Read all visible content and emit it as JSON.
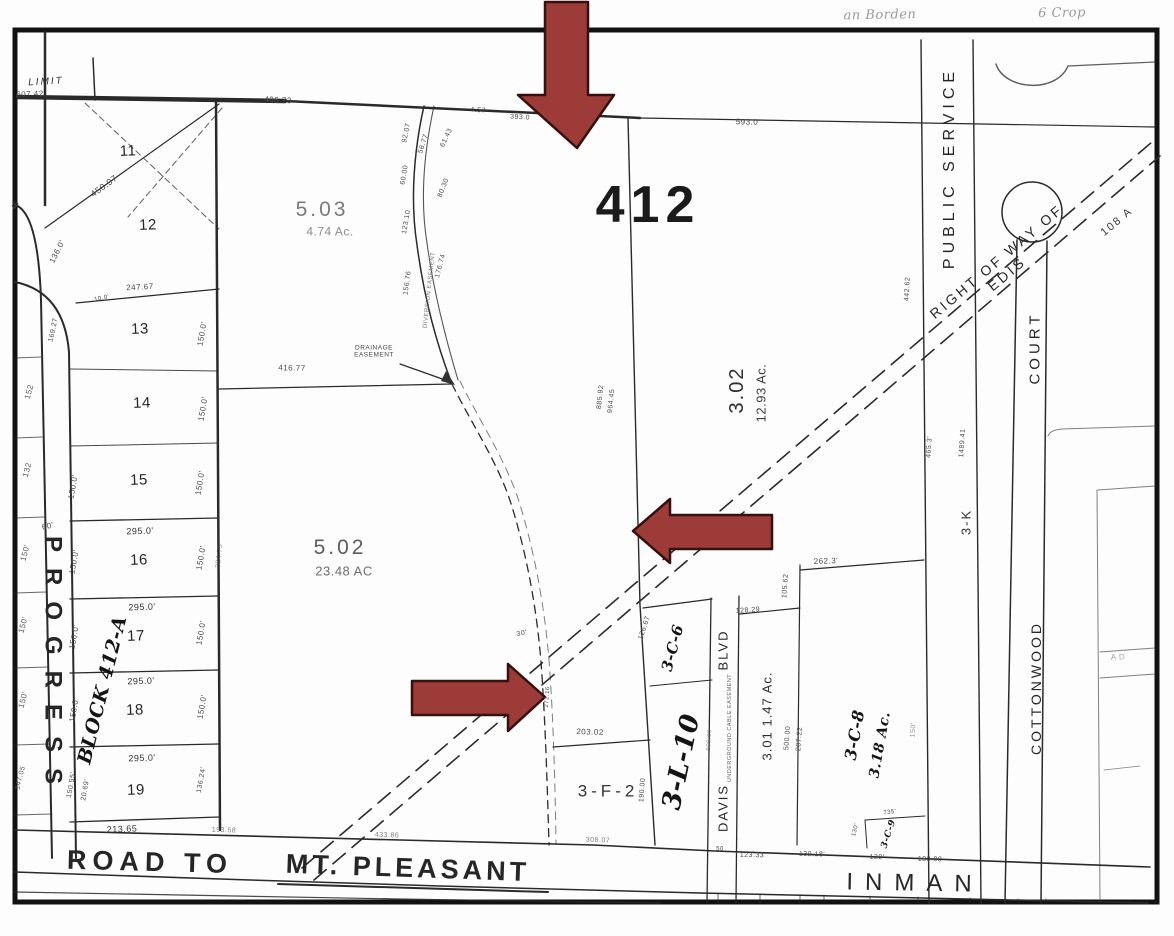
{
  "notes": {
    "top_left": "an Borden",
    "top_right": "6  Crop"
  },
  "streets": {
    "progress": "PROGRESS",
    "road_to": "ROAD  TO",
    "mt_pleasant": "MT. PLEASANT",
    "inman": "INMAN",
    "davis": "DAVIS",
    "blvd": "BLVD",
    "underground": "UNDERGROUND CABLE EASEMENT",
    "cottonwood": "COTTONWOOD",
    "court": "COURT",
    "public_service": "PUBLIC  SERVICE",
    "right_of_way": "RIGHT  OF  WAY  OF  EDIS",
    "row_108": "108 A"
  },
  "parcels": {
    "p412": "412",
    "p503": "5.03",
    "p503_ac": "4.74 Ac.",
    "p502": "5.02",
    "p502_ac": "23.48 AC",
    "p302": "3.02",
    "p302_ac": "12.93 Ac.",
    "p3f2": "3-F-2",
    "p3l10": "3-L-10",
    "p3c6": "3-C-6",
    "p301": "3.01  1.47 Ac.",
    "p3c8": "3-C-8",
    "p3c8_ac": "3.18 Ac.",
    "p3c9": "3-C-9",
    "p3k": "3-K",
    "block": "BLOCK 412-A",
    "limit": "LIMIT"
  },
  "easements": {
    "drainage": "DRAINAGE\nEASEMENT",
    "diversion": "DIVERSION EASEMENT"
  },
  "lots": [
    "11",
    "12",
    "13",
    "14",
    "15",
    "16",
    "17",
    "18",
    "19"
  ],
  "left_col": [
    "152",
    "132",
    "150'",
    "150'",
    "150'",
    "147.05"
  ],
  "measurements": [
    "607.42",
    "406.73",
    "4.57",
    "393.0",
    "593.0'",
    "450.97",
    "45",
    "136.0'",
    "247.67",
    "169.27",
    "10.0'",
    "416.77",
    "92.07",
    "56.77",
    "61.43",
    "60.00",
    "80.30",
    "123.10",
    "156.76",
    "176.74",
    "885.92",
    "964.45",
    "442.62",
    "465.3'",
    "1489.41",
    "295.0'",
    "295.0'",
    "295.0'",
    "295.0'",
    "213.65",
    "150.0'",
    "150.0'",
    "150.0'",
    "150.0'",
    "150.0'",
    "150.0'",
    "150.0'",
    "150.0'",
    "150.55'",
    "20.69'",
    "136.24'",
    "60'",
    "324.75",
    "193.58",
    "433.86",
    "308.07",
    "203.02",
    "272.16",
    "30'",
    "190.00",
    "126.67",
    "128.29",
    "105.62",
    "500.00",
    "207.22",
    "600.00",
    "262.3'",
    "150'",
    "735'",
    "130'",
    "50",
    "123.33",
    "139.18'",
    "120'",
    "180.00",
    "150.0'",
    "150.0'",
    "A D"
  ],
  "arrow_color": "#9c3b38"
}
